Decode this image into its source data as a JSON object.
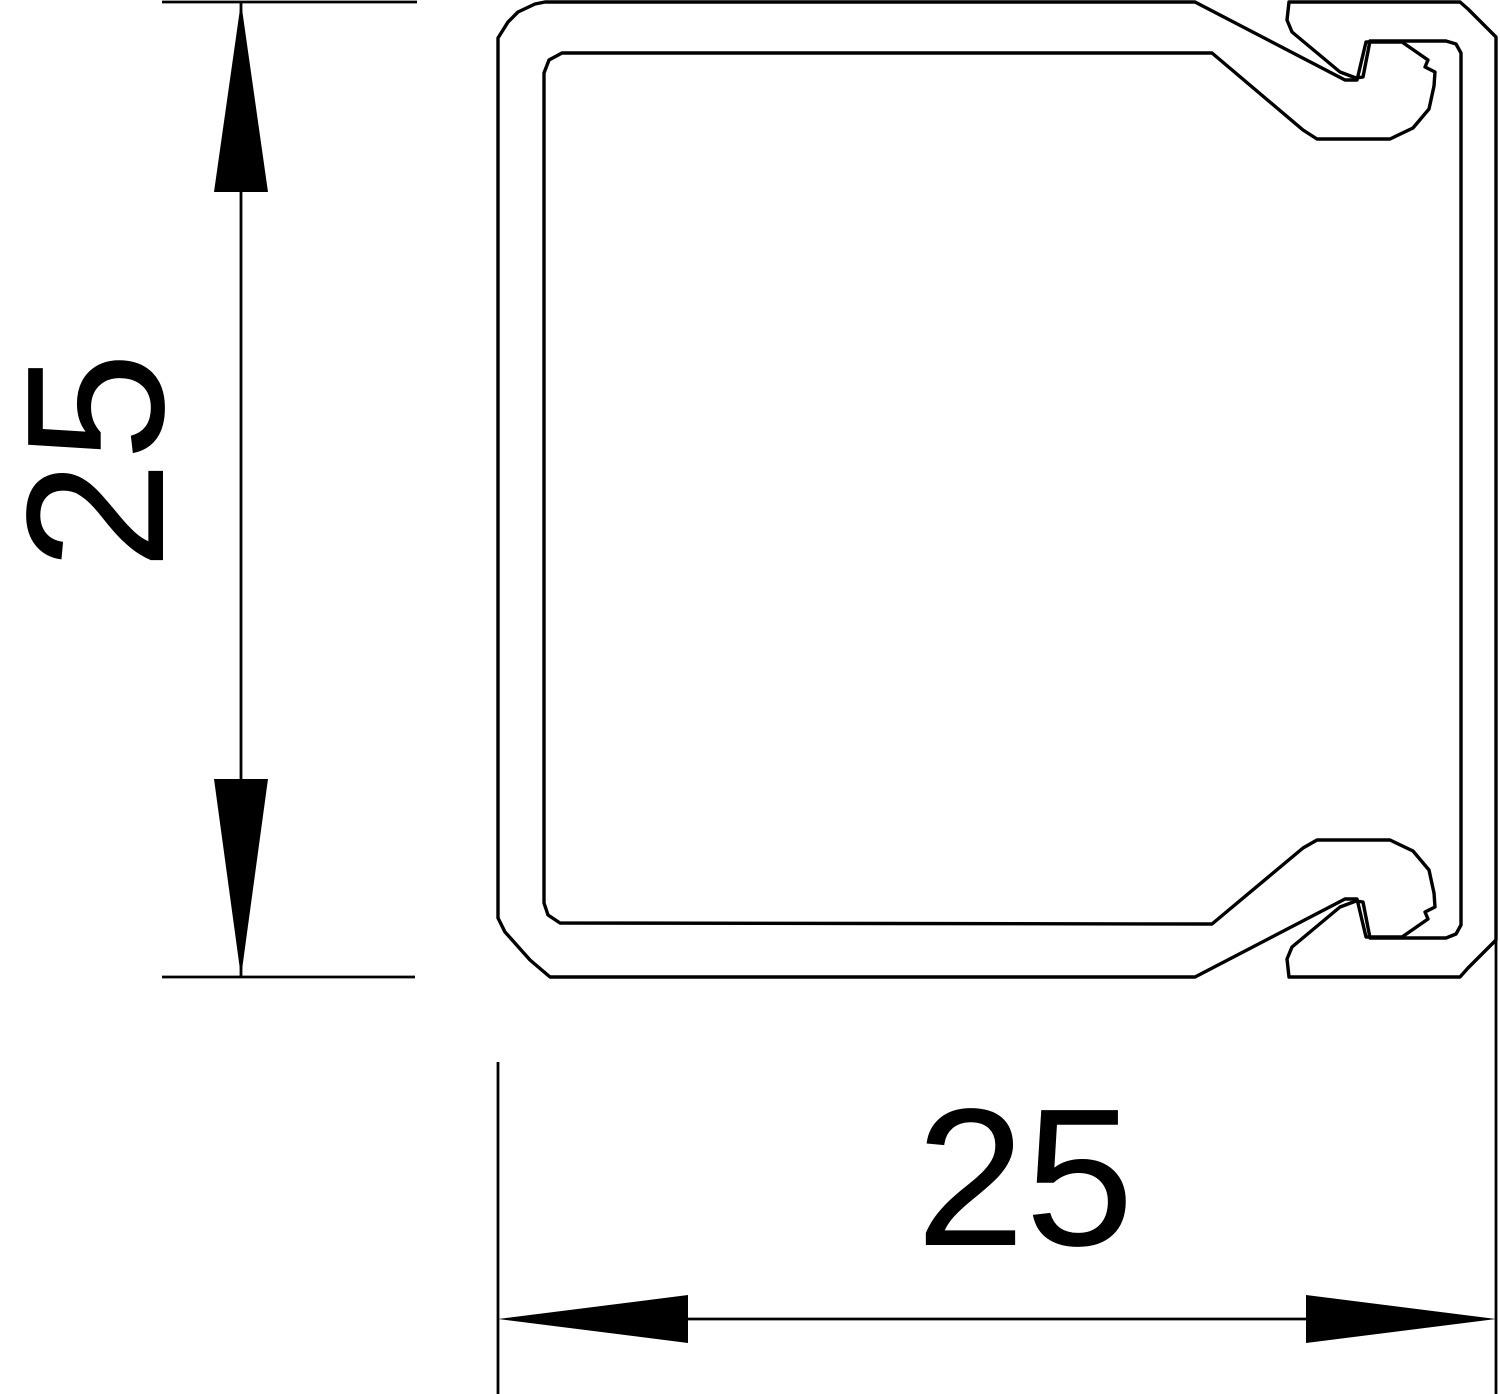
{
  "drawing": {
    "type": "technical-cross-section",
    "vertical_dimension": {
      "label": "25"
    },
    "horizontal_dimension": {
      "label": "25"
    },
    "line_color": "#000000",
    "background_color": "#ffffff"
  }
}
